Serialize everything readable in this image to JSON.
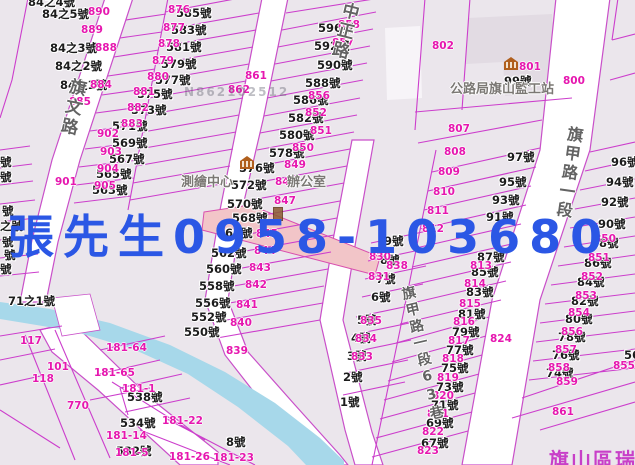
{
  "colors": {
    "watermark_blue": "#2b57e5",
    "parcel_line": "#cc3ecc",
    "parcel_number": "#e617af",
    "water": "#a7d8ea",
    "highlight_parcel": "#f2c5c8",
    "district_label": "#c83fc8"
  },
  "watermark_blue": {
    "t": "張先生0958-103680"
  },
  "watermark_gray": {
    "t": "N862102512"
  },
  "district_label": {
    "t": "旗山區瑞"
  },
  "road_labels": [
    {
      "text": "旗文路",
      "x": 68,
      "y": 78,
      "angle": 12,
      "size": 17
    },
    {
      "text": "中正路",
      "x": 341,
      "y": 2,
      "angle": 14,
      "size": 17
    },
    {
      "text": "旗甲路一段",
      "x": 566,
      "y": 126,
      "angle": 8,
      "size": 16
    },
    {
      "text": "旗甲路一段63巷",
      "x": 398,
      "y": 286,
      "angle": -13,
      "size": 14
    }
  ],
  "landmark_texts": [
    {
      "t": "公路局旗山監工站",
      "x": 450,
      "y": 83
    },
    {
      "t": "測繪中心",
      "x": 181,
      "y": 176
    },
    {
      "t": "辦公室",
      "x": 287,
      "y": 176
    }
  ],
  "landmark_icons": [
    {
      "x": 504,
      "y": 57
    },
    {
      "x": 240,
      "y": 156
    }
  ],
  "small_icon": {
    "x": 273,
    "y": 207
  },
  "house_numbers": [
    {
      "t": "84之4號",
      "x": 28,
      "y": -4
    },
    {
      "t": "84之5號",
      "x": 42,
      "y": 8
    },
    {
      "t": "84之3號",
      "x": 50,
      "y": 42
    },
    {
      "t": "84之2號",
      "x": 55,
      "y": 60
    },
    {
      "t": "84之1號",
      "x": 60,
      "y": 79
    },
    {
      "t": "585號",
      "x": 176,
      "y": 7
    },
    {
      "t": "583號",
      "x": 171,
      "y": 24
    },
    {
      "t": "581號",
      "x": 166,
      "y": 41
    },
    {
      "t": "579號",
      "x": 161,
      "y": 58
    },
    {
      "t": "577號",
      "x": 155,
      "y": 74
    },
    {
      "t": "575號",
      "x": 137,
      "y": 88
    },
    {
      "t": "573號",
      "x": 131,
      "y": 104
    },
    {
      "t": "571號",
      "x": 112,
      "y": 120
    },
    {
      "t": "569號",
      "x": 112,
      "y": 137
    },
    {
      "t": "567號",
      "x": 109,
      "y": 153
    },
    {
      "t": "565號",
      "x": 96,
      "y": 168
    },
    {
      "t": "563號",
      "x": 92,
      "y": 184
    },
    {
      "t": "596號",
      "x": 318,
      "y": 22
    },
    {
      "t": "592號",
      "x": 314,
      "y": 40
    },
    {
      "t": "590號",
      "x": 317,
      "y": 59
    },
    {
      "t": "588號",
      "x": 305,
      "y": 77
    },
    {
      "t": "586號",
      "x": 293,
      "y": 94
    },
    {
      "t": "582號",
      "x": 288,
      "y": 112
    },
    {
      "t": "580號",
      "x": 279,
      "y": 129
    },
    {
      "t": "578號",
      "x": 269,
      "y": 147
    },
    {
      "t": "576號",
      "x": 239,
      "y": 162
    },
    {
      "t": "572號",
      "x": 231,
      "y": 179
    },
    {
      "t": "570號",
      "x": 227,
      "y": 198
    },
    {
      "t": "568號",
      "x": 232,
      "y": 212
    },
    {
      "t": "566號",
      "x": 217,
      "y": 227
    },
    {
      "t": "562號",
      "x": 211,
      "y": 247
    },
    {
      "t": "560號",
      "x": 206,
      "y": 263
    },
    {
      "t": "558號",
      "x": 199,
      "y": 280
    },
    {
      "t": "556號",
      "x": 195,
      "y": 297
    },
    {
      "t": "552號",
      "x": 191,
      "y": 311
    },
    {
      "t": "550號",
      "x": 184,
      "y": 326
    },
    {
      "t": "538號",
      "x": 127,
      "y": 391
    },
    {
      "t": "534號",
      "x": 120,
      "y": 417
    },
    {
      "t": "532號",
      "x": 116,
      "y": 445
    },
    {
      "t": "71之1號",
      "x": 8,
      "y": 295
    },
    {
      "t": "8號",
      "x": 226,
      "y": 436
    },
    {
      "t": "99號",
      "x": 504,
      "y": 75
    },
    {
      "t": "9號",
      "x": 384,
      "y": 235
    },
    {
      "t": "8號",
      "x": 380,
      "y": 254
    },
    {
      "t": "7號",
      "x": 376,
      "y": 273
    },
    {
      "t": "6號",
      "x": 371,
      "y": 291
    },
    {
      "t": "5號",
      "x": 357,
      "y": 314
    },
    {
      "t": "4號",
      "x": 351,
      "y": 332
    },
    {
      "t": "3號",
      "x": 347,
      "y": 350
    },
    {
      "t": "2號",
      "x": 343,
      "y": 371
    },
    {
      "t": "1號",
      "x": 340,
      "y": 396
    },
    {
      "t": "97號",
      "x": 507,
      "y": 151
    },
    {
      "t": "95號",
      "x": 499,
      "y": 176
    },
    {
      "t": "93號",
      "x": 492,
      "y": 194
    },
    {
      "t": "91號",
      "x": 486,
      "y": 211
    },
    {
      "t": "87號",
      "x": 477,
      "y": 251
    },
    {
      "t": "85號",
      "x": 471,
      "y": 266
    },
    {
      "t": "83號",
      "x": 466,
      "y": 286
    },
    {
      "t": "81號",
      "x": 458,
      "y": 308
    },
    {
      "t": "79號",
      "x": 452,
      "y": 326
    },
    {
      "t": "77號",
      "x": 446,
      "y": 344
    },
    {
      "t": "75號",
      "x": 441,
      "y": 362
    },
    {
      "t": "73號",
      "x": 436,
      "y": 381
    },
    {
      "t": "71號",
      "x": 431,
      "y": 399
    },
    {
      "t": "69號",
      "x": 426,
      "y": 417
    },
    {
      "t": "67號",
      "x": 421,
      "y": 437
    },
    {
      "t": "96號",
      "x": 611,
      "y": 156
    },
    {
      "t": "94號",
      "x": 606,
      "y": 176
    },
    {
      "t": "92號",
      "x": 601,
      "y": 196
    },
    {
      "t": "90號",
      "x": 598,
      "y": 218
    },
    {
      "t": "88號",
      "x": 591,
      "y": 237
    },
    {
      "t": "86號",
      "x": 584,
      "y": 257
    },
    {
      "t": "84號",
      "x": 577,
      "y": 276
    },
    {
      "t": "82號",
      "x": 571,
      "y": 295
    },
    {
      "t": "80號",
      "x": 565,
      "y": 313
    },
    {
      "t": "78號",
      "x": 558,
      "y": 331
    },
    {
      "t": "76號",
      "x": 552,
      "y": 349
    },
    {
      "t": "74號",
      "x": 546,
      "y": 367
    },
    {
      "t": "56",
      "x": 624,
      "y": 349
    },
    {
      "t": "號",
      "x": 0,
      "y": 156
    },
    {
      "t": "號",
      "x": 0,
      "y": 171
    },
    {
      "t": "號",
      "x": 2,
      "y": 205
    },
    {
      "t": "之號",
      "x": 0,
      "y": 220
    },
    {
      "t": "號",
      "x": 2,
      "y": 236
    },
    {
      "t": "號",
      "x": 4,
      "y": 249
    },
    {
      "t": "號",
      "x": 0,
      "y": 263
    }
  ],
  "parcel_numbers": [
    {
      "t": "890",
      "x": 88,
      "y": 7
    },
    {
      "t": "889",
      "x": 81,
      "y": 25
    },
    {
      "t": "888",
      "x": 95,
      "y": 43
    },
    {
      "t": "884",
      "x": 90,
      "y": 80
    },
    {
      "t": "885",
      "x": 69,
      "y": 97
    },
    {
      "t": "902",
      "x": 97,
      "y": 129
    },
    {
      "t": "903",
      "x": 100,
      "y": 147
    },
    {
      "t": "904",
      "x": 97,
      "y": 164
    },
    {
      "t": "905",
      "x": 94,
      "y": 181
    },
    {
      "t": "901",
      "x": 55,
      "y": 177
    },
    {
      "t": "876",
      "x": 168,
      "y": 5
    },
    {
      "t": "877",
      "x": 163,
      "y": 23
    },
    {
      "t": "878",
      "x": 158,
      "y": 39
    },
    {
      "t": "879",
      "x": 152,
      "y": 56
    },
    {
      "t": "880",
      "x": 147,
      "y": 72
    },
    {
      "t": "881",
      "x": 133,
      "y": 87
    },
    {
      "t": "882",
      "x": 127,
      "y": 103
    },
    {
      "t": "883",
      "x": 121,
      "y": 119
    },
    {
      "t": "861",
      "x": 245,
      "y": 71
    },
    {
      "t": "862",
      "x": 228,
      "y": 85
    },
    {
      "t": "858",
      "x": 338,
      "y": 20
    },
    {
      "t": "857",
      "x": 332,
      "y": 38
    },
    {
      "t": "856",
      "x": 308,
      "y": 91
    },
    {
      "t": "852",
      "x": 305,
      "y": 108
    },
    {
      "t": "851",
      "x": 310,
      "y": 126
    },
    {
      "t": "850",
      "x": 292,
      "y": 143
    },
    {
      "t": "849",
      "x": 284,
      "y": 160
    },
    {
      "t": "848",
      "x": 275,
      "y": 177
    },
    {
      "t": "847",
      "x": 274,
      "y": 196
    },
    {
      "t": "845",
      "x": 256,
      "y": 229
    },
    {
      "t": "844",
      "x": 254,
      "y": 246
    },
    {
      "t": "843",
      "x": 249,
      "y": 263
    },
    {
      "t": "842",
      "x": 245,
      "y": 280
    },
    {
      "t": "841",
      "x": 236,
      "y": 300
    },
    {
      "t": "840",
      "x": 230,
      "y": 318
    },
    {
      "t": "839",
      "x": 226,
      "y": 346
    },
    {
      "t": "838",
      "x": 386,
      "y": 261
    },
    {
      "t": "830",
      "x": 369,
      "y": 252
    },
    {
      "t": "831",
      "x": 368,
      "y": 272
    },
    {
      "t": "835",
      "x": 360,
      "y": 316
    },
    {
      "t": "834",
      "x": 355,
      "y": 334
    },
    {
      "t": "833",
      "x": 351,
      "y": 352
    },
    {
      "t": "802",
      "x": 432,
      "y": 41
    },
    {
      "t": "801",
      "x": 519,
      "y": 62
    },
    {
      "t": "800",
      "x": 563,
      "y": 76
    },
    {
      "t": "807",
      "x": 448,
      "y": 124
    },
    {
      "t": "808",
      "x": 444,
      "y": 147
    },
    {
      "t": "809",
      "x": 438,
      "y": 167
    },
    {
      "t": "810",
      "x": 433,
      "y": 187
    },
    {
      "t": "811",
      "x": 427,
      "y": 206
    },
    {
      "t": "812",
      "x": 422,
      "y": 224
    },
    {
      "t": "813",
      "x": 470,
      "y": 261
    },
    {
      "t": "814",
      "x": 464,
      "y": 279
    },
    {
      "t": "815",
      "x": 459,
      "y": 299
    },
    {
      "t": "816",
      "x": 453,
      "y": 317
    },
    {
      "t": "817",
      "x": 448,
      "y": 336
    },
    {
      "t": "818",
      "x": 442,
      "y": 354
    },
    {
      "t": "819",
      "x": 437,
      "y": 373
    },
    {
      "t": "820",
      "x": 432,
      "y": 391
    },
    {
      "t": "821",
      "x": 427,
      "y": 409
    },
    {
      "t": "822",
      "x": 422,
      "y": 427
    },
    {
      "t": "823",
      "x": 417,
      "y": 446
    },
    {
      "t": "824",
      "x": 490,
      "y": 334
    },
    {
      "t": "850",
      "x": 594,
      "y": 234
    },
    {
      "t": "851",
      "x": 588,
      "y": 253
    },
    {
      "t": "852",
      "x": 581,
      "y": 272
    },
    {
      "t": "853",
      "x": 575,
      "y": 291
    },
    {
      "t": "854",
      "x": 568,
      "y": 308
    },
    {
      "t": "856",
      "x": 561,
      "y": 327
    },
    {
      "t": "857",
      "x": 555,
      "y": 345
    },
    {
      "t": "858",
      "x": 548,
      "y": 363
    },
    {
      "t": "859",
      "x": 556,
      "y": 377
    },
    {
      "t": "861",
      "x": 552,
      "y": 407
    },
    {
      "t": "855",
      "x": 613,
      "y": 361
    },
    {
      "t": "117",
      "x": 20,
      "y": 336
    },
    {
      "t": "101",
      "x": 47,
      "y": 362
    },
    {
      "t": "118",
      "x": 32,
      "y": 374
    },
    {
      "t": "770",
      "x": 67,
      "y": 401
    },
    {
      "t": "181-64",
      "x": 106,
      "y": 343
    },
    {
      "t": "181-65",
      "x": 94,
      "y": 368
    },
    {
      "t": "181-1",
      "x": 122,
      "y": 384
    },
    {
      "t": "181-14",
      "x": 106,
      "y": 431
    },
    {
      "t": "181-5",
      "x": 115,
      "y": 448
    },
    {
      "t": "181-22",
      "x": 162,
      "y": 416
    },
    {
      "t": "181-26",
      "x": 169,
      "y": 452
    },
    {
      "t": "181-23",
      "x": 213,
      "y": 453
    }
  ]
}
